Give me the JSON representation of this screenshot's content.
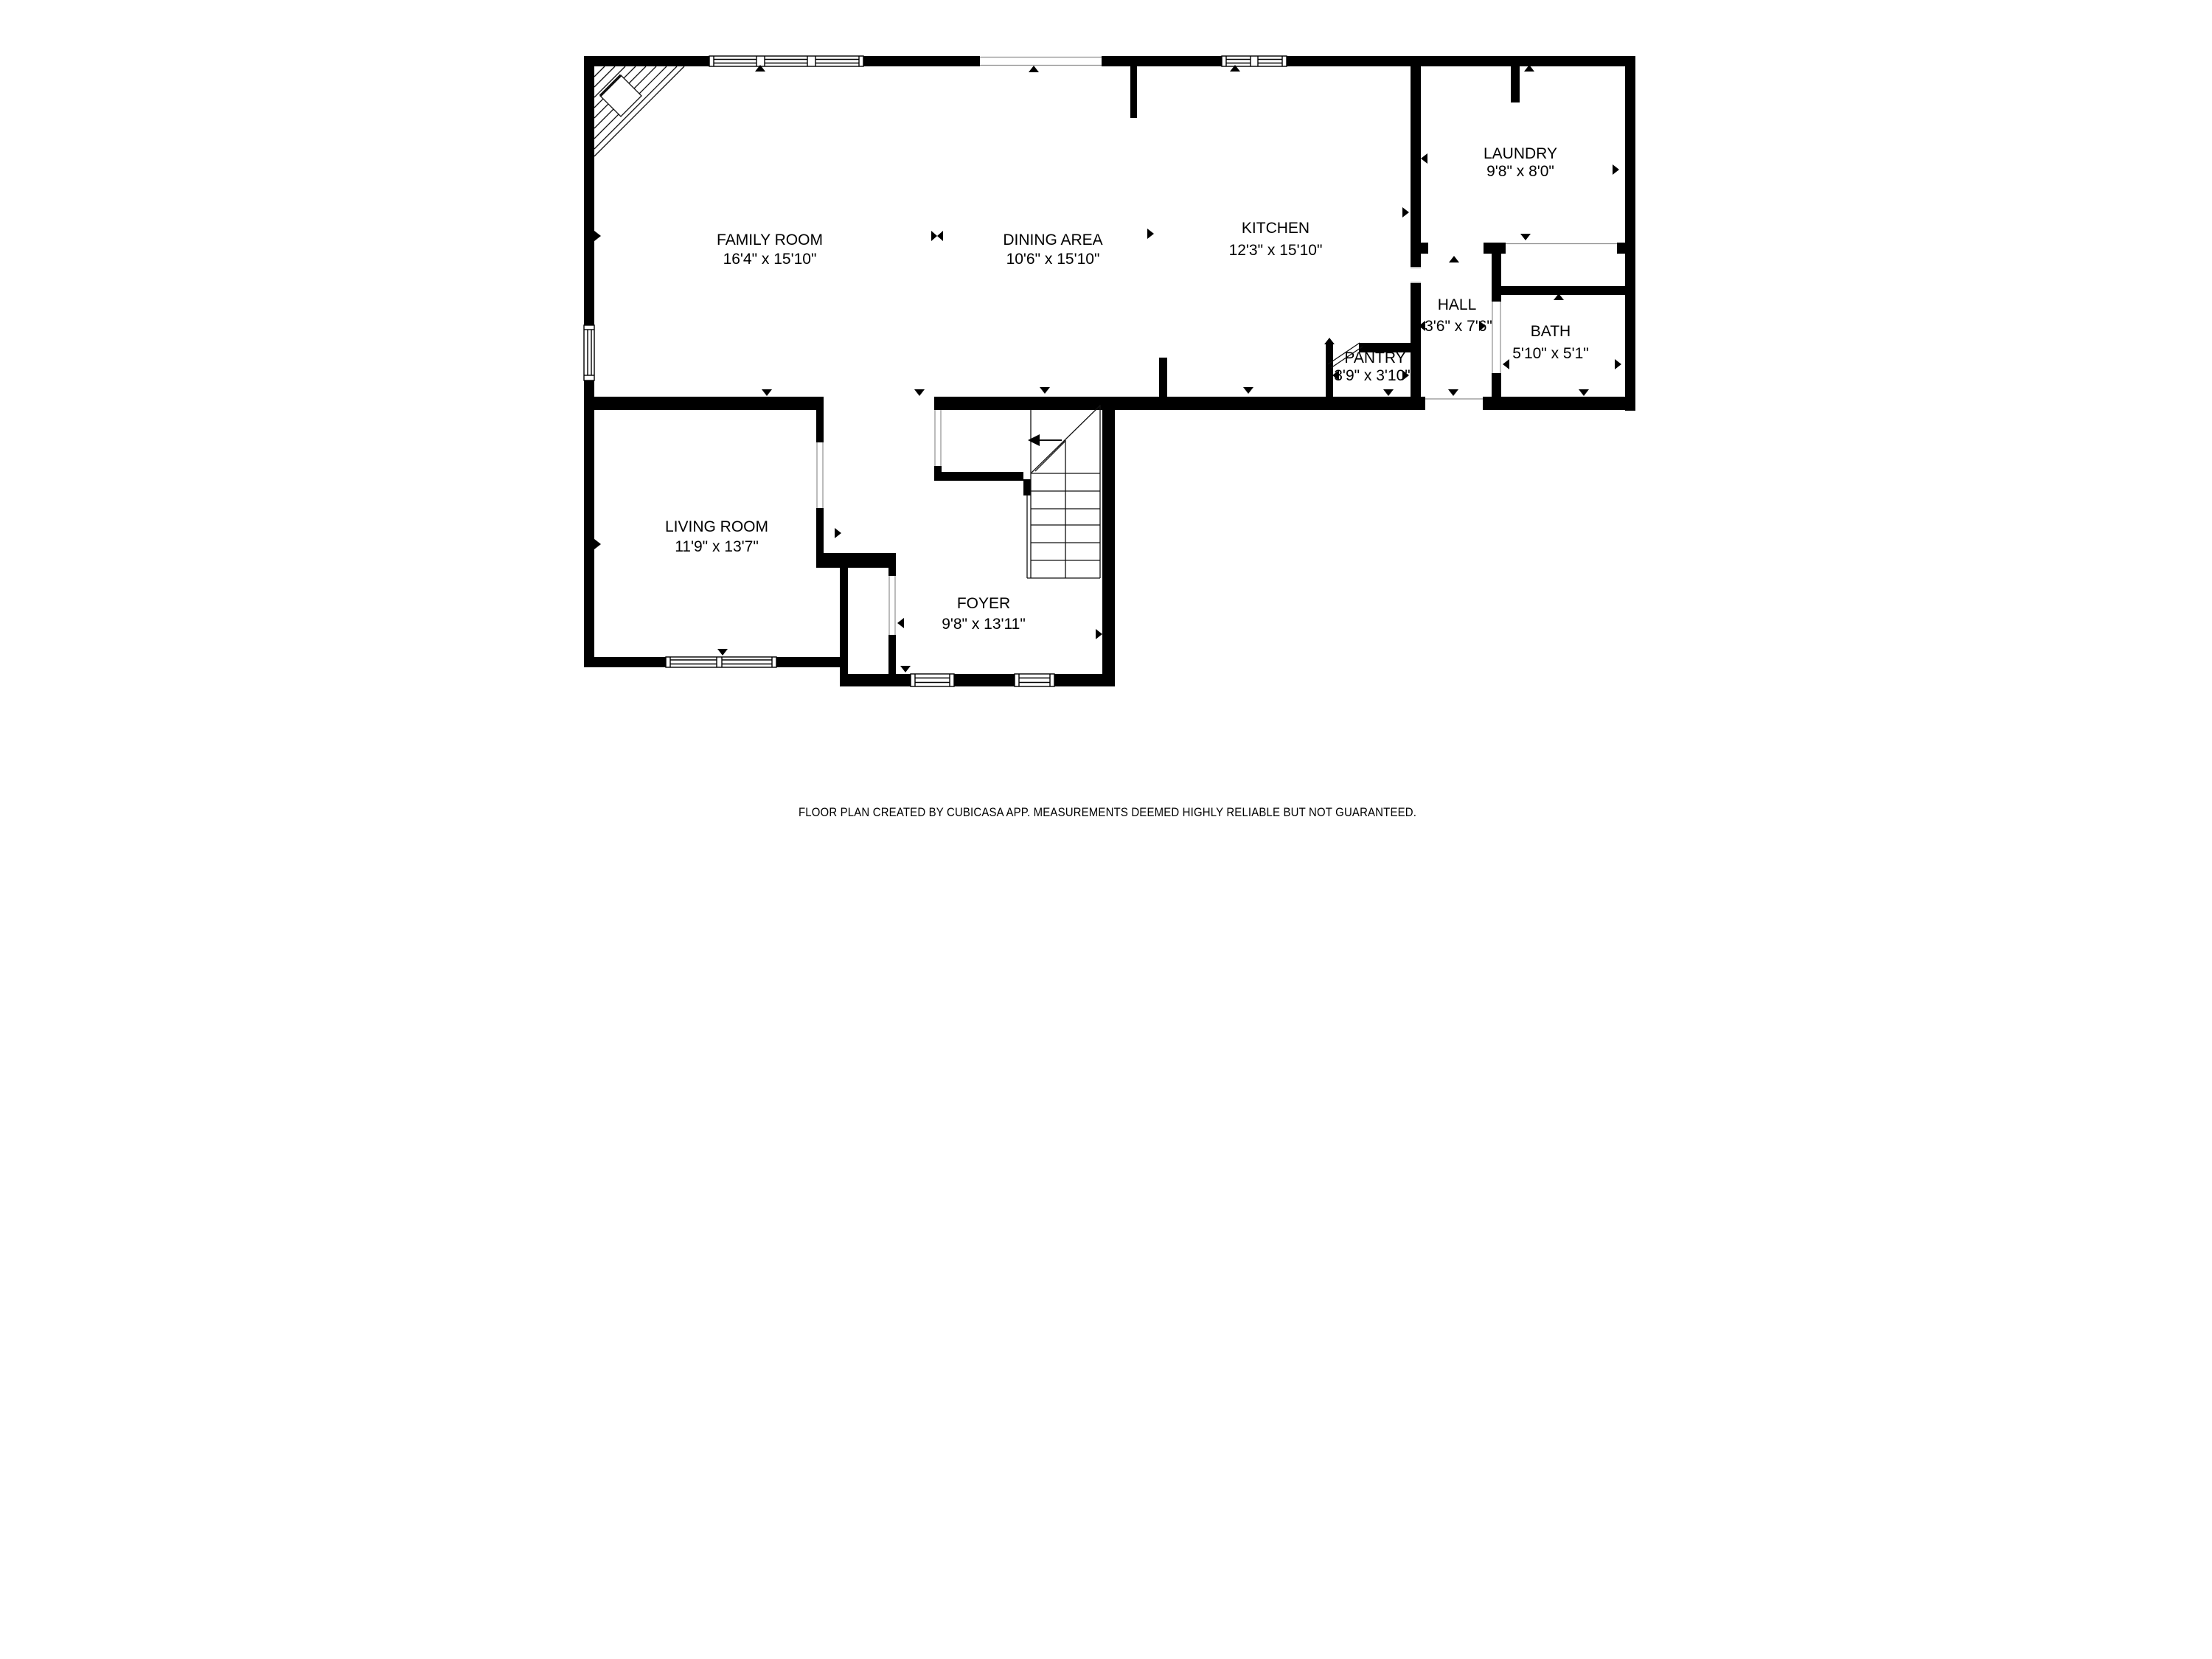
{
  "rooms": [
    {
      "id": "family-room",
      "name": "FAMILY ROOM",
      "dims": "16'4\" x 15'10\""
    },
    {
      "id": "dining-area",
      "name": "DINING AREA",
      "dims": "10'6\" x 15'10\""
    },
    {
      "id": "kitchen",
      "name": "KITCHEN",
      "dims": "12'3\" x 15'10\""
    },
    {
      "id": "laundry",
      "name": "LAUNDRY",
      "dims": "9'8\" x 8'0\""
    },
    {
      "id": "hall",
      "name": "HALL",
      "dims": "3'6\" x 7'6\""
    },
    {
      "id": "bath",
      "name": "BATH",
      "dims": "5'10\" x 5'1\""
    },
    {
      "id": "pantry",
      "name": "PANTRY",
      "dims": "3'9\" x 3'10\""
    },
    {
      "id": "living-room",
      "name": "LIVING ROOM",
      "dims": "11'9\" x 13'7\""
    },
    {
      "id": "foyer",
      "name": "FOYER",
      "dims": "9'8\" x 13'11\""
    }
  ],
  "footer": {
    "text": "FLOOR PLAN CREATED BY CUBICASA APP. MEASUREMENTS DEEMED HIGHLY RELIABLE BUT NOT GUARANTEED."
  },
  "colors": {
    "wall": "#000000",
    "background": "#ffffff",
    "footer_text": "#9a9a9a",
    "thin_line": "#111111",
    "opening_line": "#8f8f8f"
  }
}
